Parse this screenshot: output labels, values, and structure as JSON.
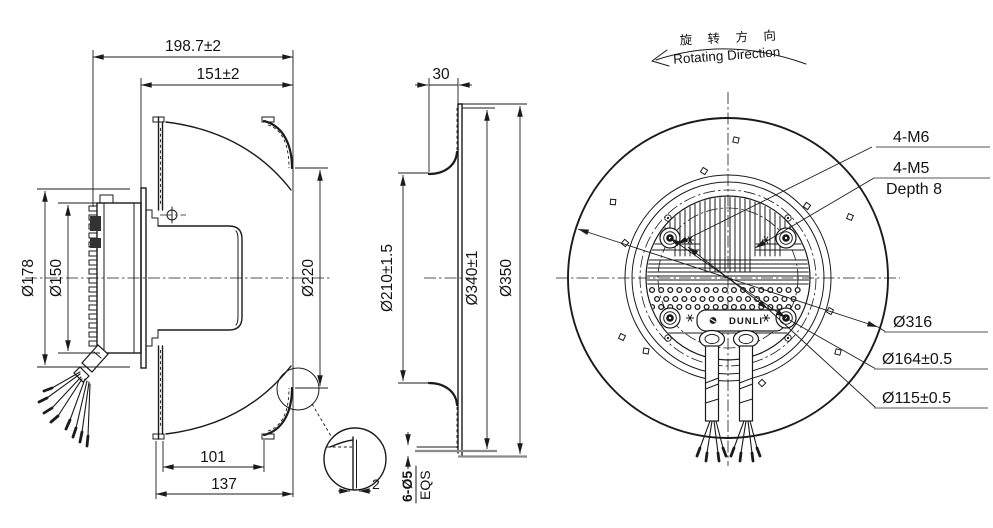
{
  "drawing": {
    "background": "#ffffff",
    "line_color": "#1b1b1b",
    "underline_color": "#8f8f8f"
  },
  "left_view": {
    "dims": {
      "depth_total": "198.7±2",
      "depth_housing": "151±2",
      "motor_flange_dia": "Ø178",
      "motor_dia": "Ø150",
      "inlet_dia": "Ø220",
      "outlet_width": "101",
      "housing_depth": "137"
    },
    "detail": {
      "sheet_thickness": "2"
    }
  },
  "middle_view": {
    "dims": {
      "inlet_ring_depth": "30",
      "opening_dia": "Ø210±1.5",
      "bolt_circle_dia": "Ø340±1",
      "flange_dia": "Ø350",
      "mount_holes": "6-Ø5",
      "hole_spacing": "EQS"
    }
  },
  "right_view": {
    "rotation_label_cn": "旋 转 方 向",
    "rotation_label_en": "Rotating Direction",
    "callouts": {
      "bolts": "4-M6",
      "tapped_holes": "4-M5",
      "tapped_depth": "Depth 8",
      "blade_dia": "Ø316",
      "mount_circle_dia": "Ø164±0.5",
      "pilot_dia": "Ø115±0.5"
    },
    "logo": "DUNLI"
  }
}
